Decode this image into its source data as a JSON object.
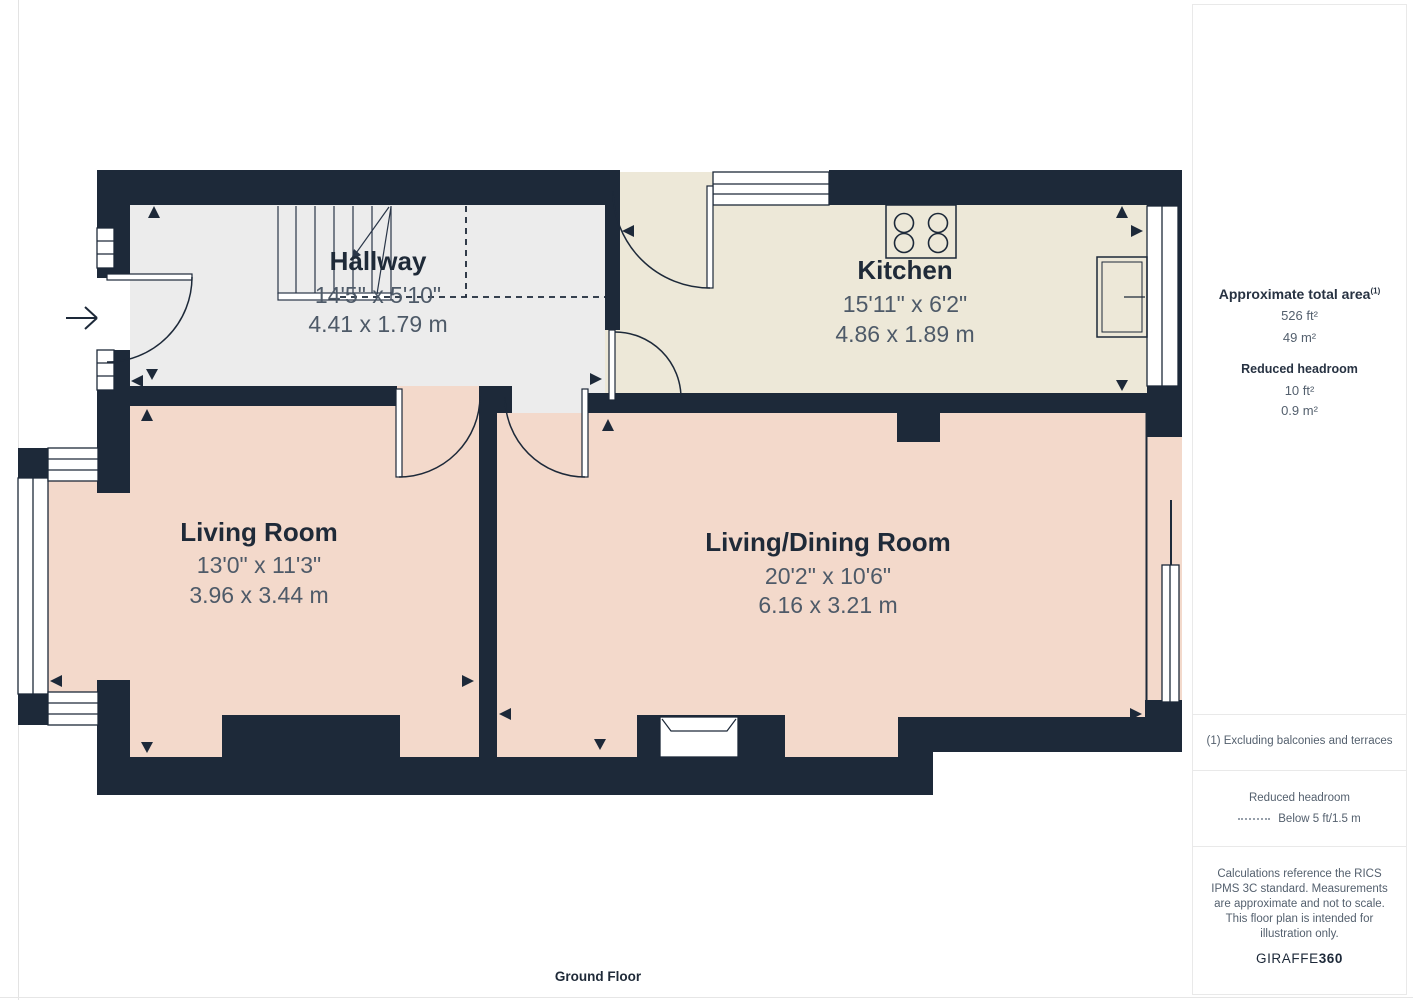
{
  "floor_label": "Ground Floor",
  "rooms": {
    "hallway": {
      "name": "Hallway",
      "imperial": "14'5\" x 5'10\"",
      "metric": "4.41 x 1.79 m"
    },
    "kitchen": {
      "name": "Kitchen",
      "imperial": "15'11\" x 6'2\"",
      "metric": "4.86 x 1.89 m"
    },
    "living_room": {
      "name": "Living Room",
      "imperial": "13'0\" x 11'3\"",
      "metric": "3.96 x 3.44 m"
    },
    "living_dining": {
      "name": "Living/Dining Room",
      "imperial": "20'2\" x 10'6\"",
      "metric": "6.16 x 3.21 m"
    }
  },
  "sidebar": {
    "total_area_label": "Approximate total area",
    "total_area_sup": "(1)",
    "total_area_ft": "526 ft²",
    "total_area_m": "49 m²",
    "reduced_label": "Reduced headroom",
    "reduced_ft": "10 ft²",
    "reduced_m": "0.9 m²",
    "footnote": "(1) Excluding balconies and terraces",
    "legend_title": "Reduced headroom",
    "legend_item": "Below 5 ft/1.5 m",
    "disclaimer": "Calculations reference the RICS IPMS 3C standard. Measurements are approximate and not to scale. This floor plan is intended for illustration only.",
    "brand_regular": "GIRAFFE",
    "brand_bold": "360"
  },
  "colors": {
    "wall": "#1d2939",
    "hallway_floor": "#ececec",
    "kitchen_floor": "#ede8d8",
    "living_floor": "#f3d9cb",
    "dimension_text": "#4e5a68"
  }
}
